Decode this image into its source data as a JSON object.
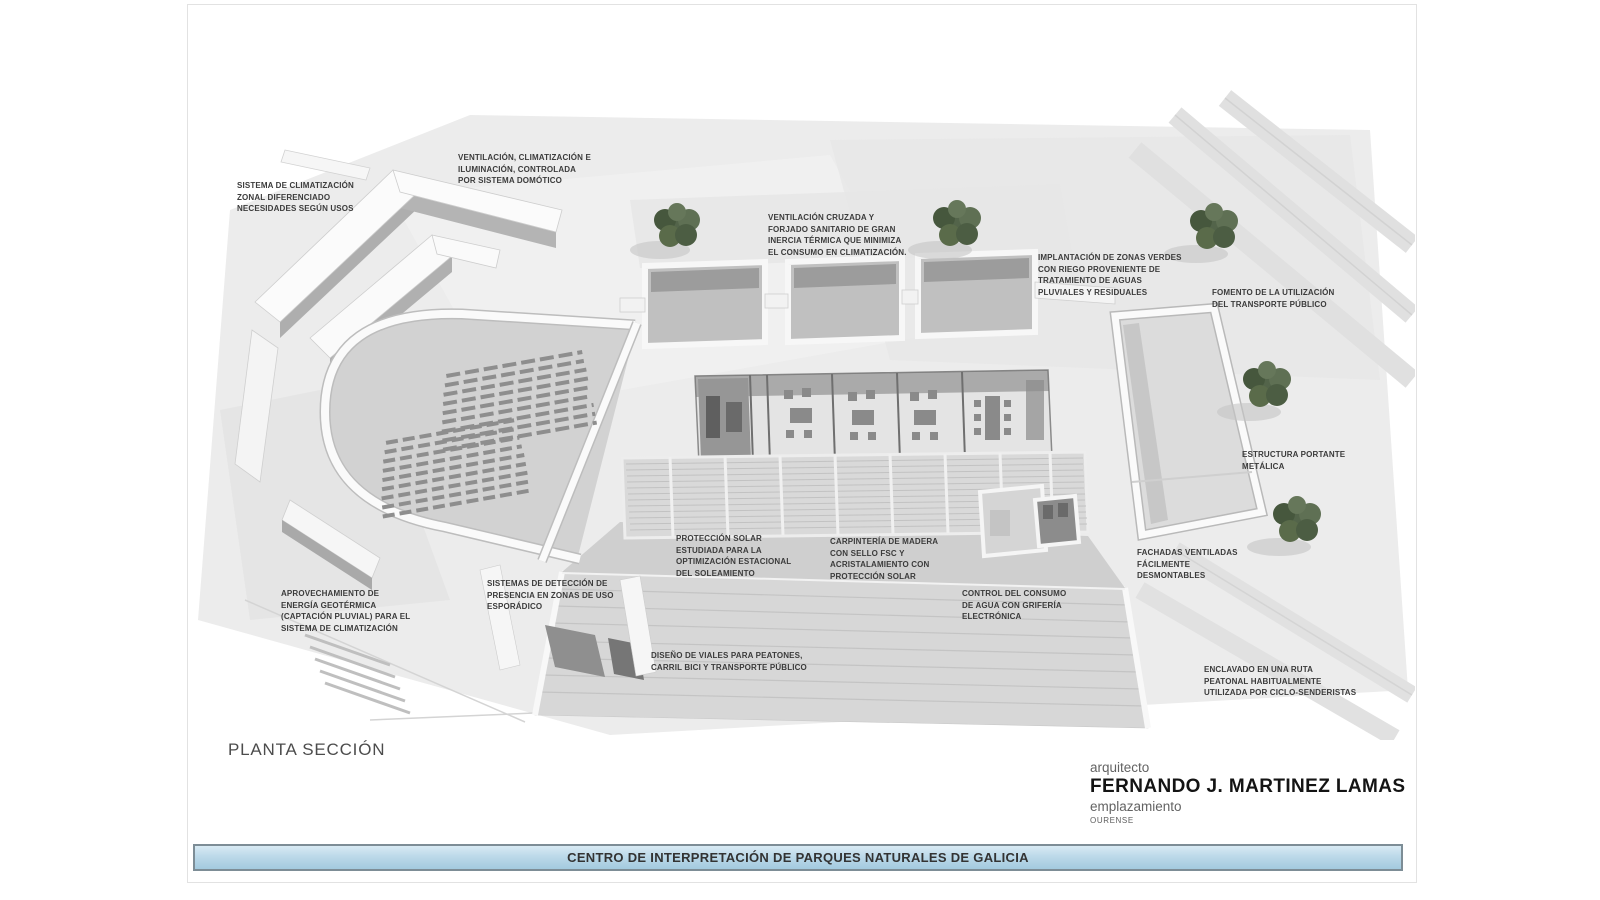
{
  "board": {
    "drawing_label": "PLANTA SECCIÓN",
    "project_title": "CENTRO DE INTERPRETACIÓN DE PARQUES NATURALES DE GALICIA"
  },
  "credits": {
    "architect_label": "arquitecto",
    "architect_name": "FERNANDO J. MARTINEZ LAMAS",
    "location_label": "emplazamiento",
    "location_value": "OURENSE"
  },
  "colors": {
    "title_bar_fill_top": "#d8eaf4",
    "title_bar_fill_bottom": "#a3cadf",
    "title_bar_border": "#7d8d96",
    "annotation_text": "#3b3b3b",
    "tree_green": "#53644a",
    "model_gray": "#d2d2d2"
  },
  "annotations": [
    {
      "id": "climatizacion-zonal",
      "text": "SISTEMA DE CLIMATIZACIÓN\nZONAL DIFERENCIADO\nNECESIDADES SEGÚN USOS"
    },
    {
      "id": "ventilacion-domotica",
      "text": "VENTILACIÓN, CLIMATIZACIÓN E\nILUMINACIÓN, CONTROLADA\nPOR SISTEMA DOMÓTICO"
    },
    {
      "id": "ventilacion-cruzada",
      "text": "VENTILACIÓN CRUZADA Y\nFORJADO SANITARIO DE GRAN\nINERCIA TÉRMICA QUE MINIMIZA\nEL CONSUMO EN CLIMATIZACIÓN."
    },
    {
      "id": "zonas-verdes",
      "text": "IMPLANTACIÓN DE ZONAS VERDES\nCON RIEGO PROVENIENTE DE\nTRATAMIENTO DE AGUAS\nPLUVIALES Y RESIDUALES"
    },
    {
      "id": "transporte-publico",
      "text": "FOMENTO DE LA UTILIZACIÓN\nDEL TRANSPORTE PÚBLICO"
    },
    {
      "id": "estructura-metalica",
      "text": "ESTRUCTURA PORTANTE\nMETÁLICA"
    },
    {
      "id": "energia-geotermica",
      "text": "APROVECHAMIENTO DE\nENERGÍA GEOTÉRMICA\n(CAPTACIÓN PLUVIAL) PARA EL\nSISTEMA DE CLIMATIZACIÓN"
    },
    {
      "id": "deteccion-presencia",
      "text": "SISTEMAS DE DETECCIÓN DE\nPRESENCIA EN ZONAS DE USO\nESPORÁDICO"
    },
    {
      "id": "proteccion-solar",
      "text": "PROTECCIÓN SOLAR\nESTUDIADA PARA LA\nOPTIMIZACIÓN ESTACIONAL\nDEL SOLEAMIENTO"
    },
    {
      "id": "carpinteria-madera",
      "text": "CARPINTERÍA DE MADERA\nCON SELLO FSC Y\nACRISTALAMIENTO CON\nPROTECCIÓN SOLAR"
    },
    {
      "id": "control-agua",
      "text": "CONTROL DEL CONSUMO\nDE AGUA CON GRIFERÍA\nELECTRÓNICA"
    },
    {
      "id": "fachadas-ventiladas",
      "text": "FACHADAS VENTILADAS\nFÁCILMENTE\nDESMONTABLES"
    },
    {
      "id": "diseno-viales",
      "text": "DISEÑO DE VIALES PARA PEATONES,\nCARRIL BICI Y TRANSPORTE PÚBLICO"
    },
    {
      "id": "ruta-peatonal",
      "text": "ENCLAVADO EN UNA RUTA\nPEATONAL HABITUALMENTE\nUTILIZADA POR CICLO-SENDERISTAS"
    }
  ]
}
